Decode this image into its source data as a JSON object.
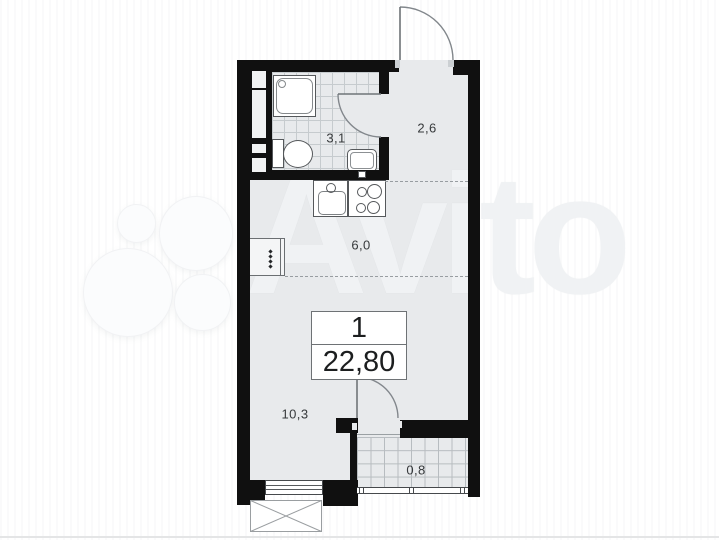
{
  "floorplan": {
    "unit_label": "1",
    "total_area": "22,80",
    "rooms": [
      {
        "id": "bathroom",
        "area_label": "3,1"
      },
      {
        "id": "hallway",
        "area_label": "2,6"
      },
      {
        "id": "kitchen",
        "area_label": "6,0"
      },
      {
        "id": "living-room",
        "area_label": "10,3"
      },
      {
        "id": "balcony",
        "area_label": "0,8"
      }
    ],
    "fixtures": [
      "shower",
      "toilet",
      "bathroom-sink",
      "kitchen-sink",
      "stove",
      "wardrobe",
      "entrance-door",
      "bathroom-door",
      "balcony-door",
      "window",
      "balcony-glazing",
      "exterior-cross-box"
    ],
    "colors": {
      "wall": "#101010",
      "floor": "#e8eaec",
      "tile_line": "#c6cbce",
      "balcony_tile_line": "#b7bcc0",
      "background": "#ffffff",
      "label_text": "#36393b"
    }
  },
  "watermark": {
    "text": "Avito"
  }
}
